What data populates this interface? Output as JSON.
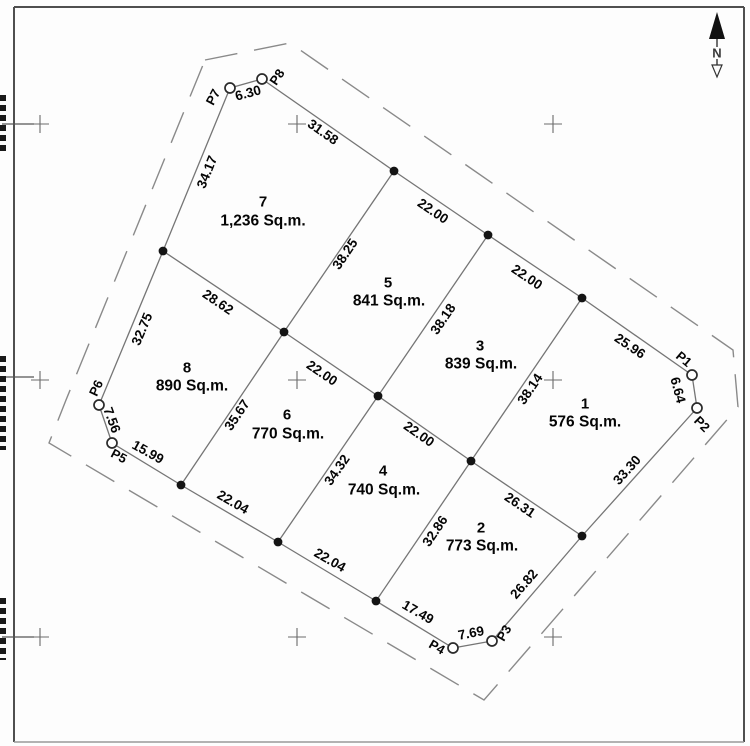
{
  "north": {
    "label": "N"
  },
  "plan": {
    "lots": [
      {
        "number": "7",
        "area": "1,236 Sq.m.",
        "nx": 263,
        "ny": 202,
        "ax": 263,
        "ay": 221
      },
      {
        "number": "5",
        "area": "841 Sq.m.",
        "nx": 388,
        "ny": 283,
        "ax": 389,
        "ay": 301
      },
      {
        "number": "3",
        "area": "839 Sq.m.",
        "nx": 480,
        "ny": 346,
        "ax": 481,
        "ay": 364
      },
      {
        "number": "1",
        "area": "576 Sq.m.",
        "nx": 585,
        "ny": 404,
        "ax": 585,
        "ay": 422
      },
      {
        "number": "8",
        "area": "890 Sq.m.",
        "nx": 187,
        "ny": 368,
        "ax": 192,
        "ay": 386
      },
      {
        "number": "6",
        "area": "770 Sq.m.",
        "nx": 287,
        "ny": 415,
        "ax": 288,
        "ay": 434
      },
      {
        "number": "4",
        "area": "740 Sq.m.",
        "nx": 383,
        "ny": 471,
        "ax": 384,
        "ay": 490
      },
      {
        "number": "2",
        "area": "773 Sq.m.",
        "nx": 481,
        "ny": 528,
        "ax": 482,
        "ay": 546
      }
    ],
    "stations": [
      {
        "name": "P1",
        "x": 692,
        "y": 375,
        "lx": 684,
        "ly": 359,
        "rot": 40
      },
      {
        "name": "P2",
        "x": 697,
        "y": 408,
        "lx": 702,
        "ly": 424,
        "rot": 45
      },
      {
        "name": "P3",
        "x": 492,
        "y": 641,
        "lx": 504,
        "ly": 633,
        "rot": -60
      },
      {
        "name": "P4",
        "x": 453,
        "y": 648,
        "lx": 437,
        "ly": 647,
        "rot": 30
      },
      {
        "name": "P5",
        "x": 112,
        "y": 443,
        "lx": 119,
        "ly": 456,
        "rot": 28
      },
      {
        "name": "P6",
        "x": 99,
        "y": 405,
        "lx": 96,
        "ly": 388,
        "rot": -65
      },
      {
        "name": "P7",
        "x": 230,
        "y": 88,
        "lx": 213,
        "ly": 97,
        "rot": -62
      },
      {
        "name": "P8",
        "x": 262,
        "y": 79,
        "lx": 277,
        "ly": 77,
        "rot": -56
      }
    ],
    "nodes": [
      [
        394,
        171
      ],
      [
        488,
        235
      ],
      [
        582,
        298
      ],
      [
        582,
        536
      ],
      [
        376,
        601
      ],
      [
        278,
        542
      ],
      [
        181,
        485
      ],
      [
        163,
        251
      ],
      [
        284,
        332
      ],
      [
        378,
        396
      ],
      [
        471,
        461
      ]
    ],
    "edges": [
      [
        230,
        88,
        262,
        79
      ],
      [
        262,
        79,
        394,
        171
      ],
      [
        394,
        171,
        488,
        235
      ],
      [
        488,
        235,
        582,
        298
      ],
      [
        582,
        298,
        692,
        375
      ],
      [
        692,
        375,
        697,
        408
      ],
      [
        697,
        408,
        582,
        536
      ],
      [
        582,
        536,
        492,
        641
      ],
      [
        492,
        641,
        453,
        648
      ],
      [
        453,
        648,
        376,
        601
      ],
      [
        376,
        601,
        278,
        542
      ],
      [
        278,
        542,
        181,
        485
      ],
      [
        181,
        485,
        112,
        443
      ],
      [
        112,
        443,
        99,
        405
      ],
      [
        99,
        405,
        163,
        251
      ],
      [
        163,
        251,
        230,
        88
      ],
      [
        163,
        251,
        284,
        332
      ],
      [
        284,
        332,
        378,
        396
      ],
      [
        378,
        396,
        471,
        461
      ],
      [
        471,
        461,
        582,
        536
      ],
      [
        394,
        171,
        284,
        332
      ],
      [
        488,
        235,
        378,
        396
      ],
      [
        582,
        298,
        471,
        461
      ],
      [
        284,
        332,
        181,
        485
      ],
      [
        378,
        396,
        278,
        542
      ],
      [
        471,
        461,
        376,
        601
      ]
    ],
    "dimensions": [
      {
        "text": "6.30",
        "x": 248,
        "y": 93,
        "rot": -15
      },
      {
        "text": "31.58",
        "x": 323,
        "y": 132,
        "rot": 35
      },
      {
        "text": "22.00",
        "x": 433,
        "y": 211,
        "rot": 34
      },
      {
        "text": "22.00",
        "x": 527,
        "y": 277,
        "rot": 34
      },
      {
        "text": "25.96",
        "x": 630,
        "y": 346,
        "rot": 34
      },
      {
        "text": "6.64",
        "x": 678,
        "y": 390,
        "rot": 75
      },
      {
        "text": "33.30",
        "x": 627,
        "y": 470,
        "rot": -48
      },
      {
        "text": "26.82",
        "x": 524,
        "y": 584,
        "rot": -49
      },
      {
        "text": "7.69",
        "x": 471,
        "y": 633,
        "rot": -11
      },
      {
        "text": "17.49",
        "x": 418,
        "y": 612,
        "rot": 30
      },
      {
        "text": "22.04",
        "x": 330,
        "y": 560,
        "rot": 30
      },
      {
        "text": "22.04",
        "x": 233,
        "y": 502,
        "rot": 30
      },
      {
        "text": "15.99",
        "x": 148,
        "y": 452,
        "rot": 29
      },
      {
        "text": "7.56",
        "x": 112,
        "y": 420,
        "rot": 70
      },
      {
        "text": "32.75",
        "x": 142,
        "y": 329,
        "rot": -67
      },
      {
        "text": "34.17",
        "x": 207,
        "y": 172,
        "rot": -68
      },
      {
        "text": "28.62",
        "x": 218,
        "y": 302,
        "rot": 34
      },
      {
        "text": "38.25",
        "x": 345,
        "y": 254,
        "rot": -56
      },
      {
        "text": "38.18",
        "x": 443,
        "y": 319,
        "rot": -56
      },
      {
        "text": "38.14",
        "x": 530,
        "y": 389,
        "rot": -56
      },
      {
        "text": "35.67",
        "x": 237,
        "y": 415,
        "rot": -56
      },
      {
        "text": "34.32",
        "x": 337,
        "y": 470,
        "rot": -55
      },
      {
        "text": "32.86",
        "x": 435,
        "y": 531,
        "rot": -56
      },
      {
        "text": "26.31",
        "x": 520,
        "y": 505,
        "rot": 34
      },
      {
        "text": "22.00",
        "x": 322,
        "y": 373,
        "rot": 34
      },
      {
        "text": "22.00",
        "x": 419,
        "y": 434,
        "rot": 35
      }
    ],
    "grid_crosses": [
      [
        40,
        124
      ],
      [
        297,
        124
      ],
      [
        553,
        124
      ],
      [
        40,
        380
      ],
      [
        297,
        380
      ],
      [
        553,
        380
      ],
      [
        40,
        637
      ],
      [
        297,
        637
      ],
      [
        553,
        637
      ]
    ],
    "dashed_boundary": [
      [
        205,
        60
      ],
      [
        290,
        43
      ],
      [
        733,
        350
      ],
      [
        738,
        407
      ],
      [
        484,
        700
      ],
      [
        49,
        443
      ],
      [
        66,
        400
      ]
    ],
    "frame": {
      "x1": 14,
      "y1": 7,
      "x2": 744,
      "y2": 742
    },
    "edge_ticks": [
      124,
      377,
      637
    ],
    "clipped_label_strips": [
      [
        95,
        152
      ],
      [
        356,
        450
      ],
      [
        598,
        660
      ]
    ]
  }
}
